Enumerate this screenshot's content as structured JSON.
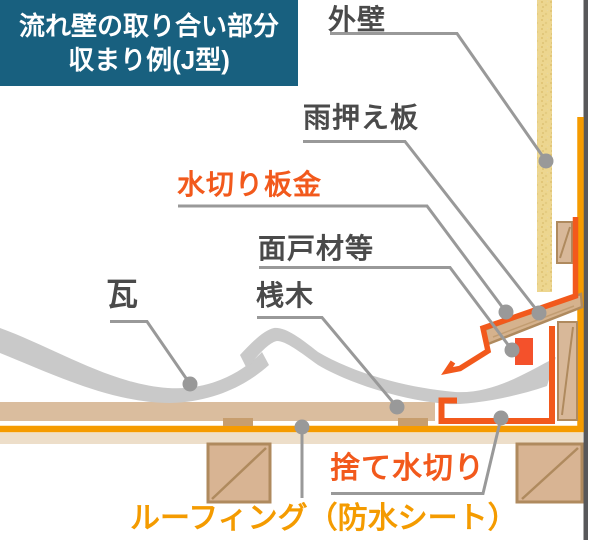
{
  "title": {
    "line1": "流れ壁の取り合い部分",
    "line2": "収まり例(J型)"
  },
  "labels": {
    "gaiheki": "外壁",
    "amaosaeita": "雨押え板",
    "mizukiri_bankin": "水切り板金",
    "mendozai": "面戸材等",
    "sangi": "桟木",
    "kawara": "瓦",
    "sute_mizukiri": "捨て水切り",
    "roofing": "ルーフィング（防水シート）"
  },
  "colors": {
    "title_bg": "#18607f",
    "title_text": "#ffffff",
    "label_gray": "#4a4a4a",
    "flashing_orange_red": "#f2591c",
    "roofing_yellow_orange": "#f59b00",
    "mendo_fill": "#f4512b",
    "tile_gray": "#c9c9c9",
    "leader_gray": "#999999",
    "structure_line_gray": "#58585a",
    "siding_sand": "#edd68f",
    "wood_fill": "#d8b899",
    "wood_border": "#af8a5e",
    "deck_band": "#eddec9",
    "bar_tan": "#dabd9e",
    "batten_tan": "#c79e6e"
  }
}
